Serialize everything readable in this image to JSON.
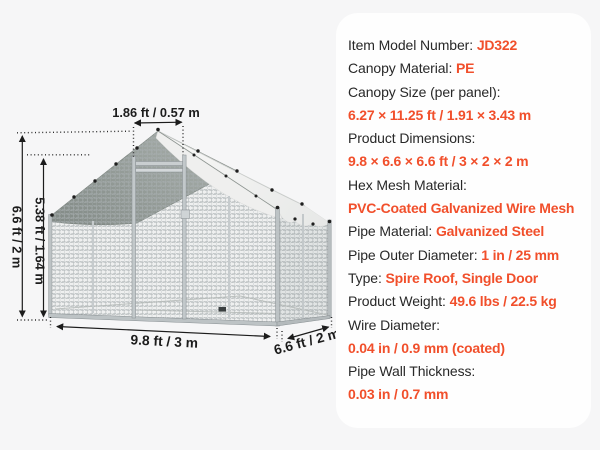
{
  "colors": {
    "background": "#f6f6f7",
    "card": "#fefefe",
    "accent": "#f14f2b",
    "text": "#282828",
    "dimension_lines": "#1c1c1c",
    "canopy_gray": "#939b97",
    "canopy_white": "#f3f3f2"
  },
  "diagram": {
    "labels": {
      "door_width": "1.86 ft / 0.57 m",
      "total_height": "6.6 ft / 2 m",
      "door_height": "5.38 ft / 1.64 m",
      "width": "9.8 ft / 3 m",
      "depth": "6.6 ft / 2 m"
    }
  },
  "specs": {
    "lines": [
      [
        {
          "text": "Item Model Number: ",
          "accent": false
        },
        {
          "text": "JD322",
          "accent": true
        }
      ],
      [
        {
          "text": "Canopy Material: ",
          "accent": false
        },
        {
          "text": "PE",
          "accent": true
        }
      ],
      [
        {
          "text": "Canopy Size (per panel):",
          "accent": false
        }
      ],
      [
        {
          "text": "6.27 × 11.25 ft / 1.91 × 3.43 m",
          "accent": true
        }
      ],
      [
        {
          "text": "Product Dimensions:",
          "accent": false
        }
      ],
      [
        {
          "text": "9.8 × 6.6 × 6.6 ft / 3 × 2 × 2 m",
          "accent": true
        }
      ],
      [
        {
          "text": "Hex Mesh Material:",
          "accent": false
        }
      ],
      [
        {
          "text": "PVC-Coated Galvanized Wire Mesh",
          "accent": true
        }
      ],
      [
        {
          "text": "Pipe Material: ",
          "accent": false
        },
        {
          "text": "Galvanized Steel",
          "accent": true
        }
      ],
      [
        {
          "text": "Pipe Outer Diameter: ",
          "accent": false
        },
        {
          "text": "1 in / 25 mm",
          "accent": true
        }
      ],
      [
        {
          "text": "Type: ",
          "accent": false
        },
        {
          "text": "Spire Roof, Single Door",
          "accent": true
        }
      ],
      [
        {
          "text": "Product Weight: ",
          "accent": false
        },
        {
          "text": "49.6 lbs / 22.5 kg",
          "accent": true
        }
      ],
      [
        {
          "text": "Wire Diameter:",
          "accent": false
        }
      ],
      [
        {
          "text": "0.04 in / 0.9 mm (coated)",
          "accent": true
        }
      ],
      [
        {
          "text": "Pipe Wall Thickness:",
          "accent": false
        }
      ],
      [
        {
          "text": "0.03 in / 0.7 mm",
          "accent": true
        }
      ]
    ]
  }
}
